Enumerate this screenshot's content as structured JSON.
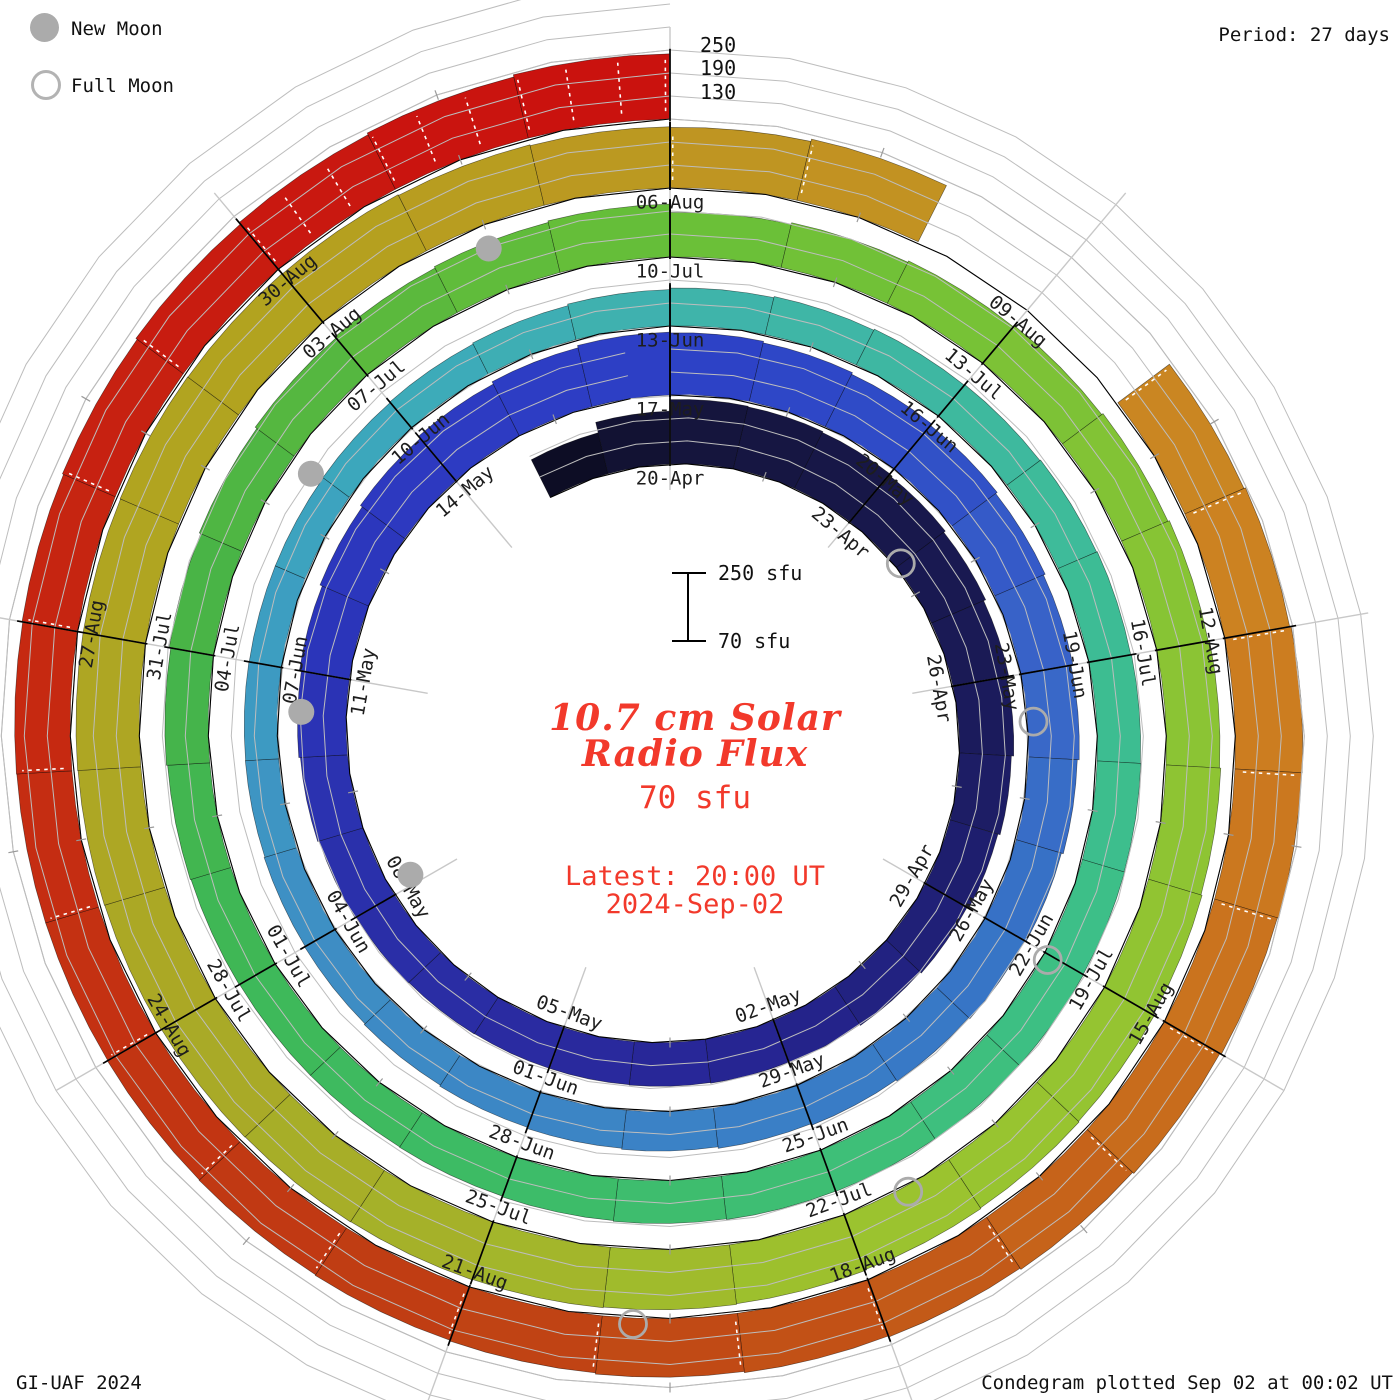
{
  "header": {
    "period_label": "Period: 27 days"
  },
  "legend": {
    "new_moon": "New Moon",
    "full_moon": "Full Moon"
  },
  "footer": {
    "left": "GI-UAF 2024",
    "right": "Condegram plotted Sep 02 at 00:02 UT"
  },
  "center": {
    "scale_top": "250 sfu",
    "scale_bottom": "70 sfu",
    "title_line1": "10.7 cm Solar",
    "title_line2": "Radio Flux",
    "subtitle": "70 sfu",
    "latest_line1": "Latest: 20:00 UT",
    "latest_line2": "2024-Sep-02",
    "accent_color": "#f2392b"
  },
  "radial_axis": {
    "labels": [
      "250",
      "190",
      "130"
    ]
  },
  "chart_data": {
    "type": "spiral_condegram",
    "quantity": "10.7 cm Solar Radio Flux (sfu)",
    "baseline_sfu": 70,
    "max_sfu": 250,
    "gridlines_sfu": [
      130,
      190,
      250
    ],
    "period_days": 27,
    "lead_in": {
      "start": "2024-04-18",
      "flux": [
        180,
        208
      ]
    },
    "rotations": [
      {
        "start": "2024-04-20",
        "hatched": false,
        "labels": [
          "20-Apr",
          "23-Apr",
          "26-Apr",
          "29-Apr",
          "02-May",
          "05-May",
          "08-May",
          "11-May",
          "14-May"
        ],
        "flux": [
          238,
          236,
          233,
          229,
          224,
          218,
          212,
          206,
          200,
          195,
          191,
          188,
          186,
          184,
          183,
          183,
          184,
          186,
          189,
          193,
          197,
          202,
          208,
          214,
          221,
          228,
          234
        ]
      },
      {
        "start": "2024-05-17",
        "hatched": false,
        "labels": [
          "17-May",
          "20-May",
          "23-May",
          "26-May",
          "29-May",
          "01-Jun",
          "04-Jun",
          "07-Jun",
          "10-Jun"
        ],
        "flux": [
          232,
          228,
          223,
          218,
          213,
          208,
          203,
          198,
          193,
          189,
          185,
          181,
          177,
          173,
          170,
          167,
          164,
          161,
          159,
          157,
          156,
          155,
          155,
          156,
          158,
          161,
          165
        ]
      },
      {
        "start": "2024-06-13",
        "hatched": false,
        "labels": [
          "13-Jun",
          "16-Jun",
          "19-Jun",
          "22-Jun",
          "25-Jun",
          "28-Jun",
          "01-Jul",
          "04-Jul",
          "07-Jul"
        ],
        "flux": [
          169,
          172,
          175,
          177,
          179,
          181,
          183,
          184,
          185,
          186,
          186,
          185,
          184,
          182,
          180,
          178,
          177,
          177,
          178,
          180,
          183,
          187,
          191,
          196,
          200,
          204,
          208
        ]
      },
      {
        "start": "2024-07-10",
        "hatched": false,
        "labels": [
          "10-Jul",
          "13-Jul",
          "16-Jul",
          "19-Jul",
          "22-Jul",
          "25-Jul",
          "28-Jul",
          "31-Jul",
          "03-Aug"
        ],
        "flux": [
          186,
          190,
          194,
          198,
          202,
          206,
          210,
          213,
          216,
          219,
          221,
          223,
          225,
          227,
          229,
          230,
          231,
          232,
          233,
          234,
          235,
          235,
          236,
          235,
          234,
          232,
          230
        ]
      },
      {
        "start": "2024-08-06",
        "hatched": true,
        "labels": [
          "06-Aug",
          "09-Aug",
          "12-Aug",
          "15-Aug",
          "18-Aug",
          "21-Aug",
          "24-Aug",
          "27-Aug",
          "30-Aug"
        ],
        "flux": [
          228,
          234,
          null,
          null,
          238,
          242,
          246,
          244,
          241,
          237,
          233,
          229,
          226,
          223,
          220,
          218,
          216,
          215,
          214,
          214,
          215,
          217,
          220,
          224,
          229,
          234,
          240
        ]
      },
      {
        "start": "2024-09-02",
        "hatched": false,
        "labels": [],
        "flux": []
      }
    ],
    "moon_markers": {
      "new": [
        {
          "date": "2024-05-08",
          "day": 18.14
        },
        {
          "date": "2024-06-06",
          "day": 47.53
        },
        {
          "date": "2024-07-05",
          "day": 76.96
        },
        {
          "date": "2024-08-04",
          "day": 106.47
        }
      ],
      "full": [
        {
          "date": "2024-04-23",
          "day": 3.99
        },
        {
          "date": "2024-05-23",
          "day": 33.58
        },
        {
          "date": "2024-06-22",
          "day": 63.05
        },
        {
          "date": "2024-07-21",
          "day": 92.43
        },
        {
          "date": "2024-08-19",
          "day": 121.77
        }
      ]
    },
    "colormap": [
      {
        "day": -2,
        "color": "#0b0b1e"
      },
      {
        "day": 0,
        "color": "#14143a"
      },
      {
        "day": 3,
        "color": "#17174a"
      },
      {
        "day": 6,
        "color": "#1a1a57"
      },
      {
        "day": 9,
        "color": "#1f1f72"
      },
      {
        "day": 12,
        "color": "#25248f"
      },
      {
        "day": 15,
        "color": "#2a2aa0"
      },
      {
        "day": 18,
        "color": "#2a2fa8"
      },
      {
        "day": 21,
        "color": "#2b34b8"
      },
      {
        "day": 24,
        "color": "#2d3ac1"
      },
      {
        "day": 27,
        "color": "#2d40c6"
      },
      {
        "day": 30,
        "color": "#2f4dc7"
      },
      {
        "day": 33,
        "color": "#3a66c8"
      },
      {
        "day": 36,
        "color": "#3673c6"
      },
      {
        "day": 39,
        "color": "#3a7ec6"
      },
      {
        "day": 42,
        "color": "#3c86c5"
      },
      {
        "day": 45,
        "color": "#3e8ec4"
      },
      {
        "day": 48,
        "color": "#3d9cc2"
      },
      {
        "day": 51,
        "color": "#3ca9bb"
      },
      {
        "day": 54,
        "color": "#3fb3ac"
      },
      {
        "day": 57,
        "color": "#3eb8a0"
      },
      {
        "day": 60,
        "color": "#3dbd93"
      },
      {
        "day": 63,
        "color": "#3dbf86"
      },
      {
        "day": 66,
        "color": "#3ebf75"
      },
      {
        "day": 69,
        "color": "#3dbb66"
      },
      {
        "day": 72,
        "color": "#3eb858"
      },
      {
        "day": 75,
        "color": "#46b348"
      },
      {
        "day": 78,
        "color": "#58b83e"
      },
      {
        "day": 81,
        "color": "#68bf38"
      },
      {
        "day": 84,
        "color": "#7ac236"
      },
      {
        "day": 87,
        "color": "#89c434"
      },
      {
        "day": 90,
        "color": "#93c431"
      },
      {
        "day": 93,
        "color": "#9cc32e"
      },
      {
        "day": 96,
        "color": "#a4b32a"
      },
      {
        "day": 99,
        "color": "#aaa826"
      },
      {
        "day": 102,
        "color": "#afa522"
      },
      {
        "day": 105,
        "color": "#b3a21e"
      },
      {
        "day": 108,
        "color": "#bd9722"
      },
      {
        "day": 111,
        "color": "#c68c22"
      },
      {
        "day": 114,
        "color": "#cd8021"
      },
      {
        "day": 117,
        "color": "#c9701d"
      },
      {
        "day": 120,
        "color": "#c25517"
      },
      {
        "day": 123,
        "color": "#bf3f13"
      },
      {
        "day": 126,
        "color": "#c33312"
      },
      {
        "day": 129,
        "color": "#c62711"
      },
      {
        "day": 132,
        "color": "#c81a10"
      },
      {
        "day": 134,
        "color": "#ca120e"
      }
    ],
    "marker_color": "#ababab",
    "grid_color": "#bdbdbd",
    "spoke_color": "#c8c8c8"
  }
}
